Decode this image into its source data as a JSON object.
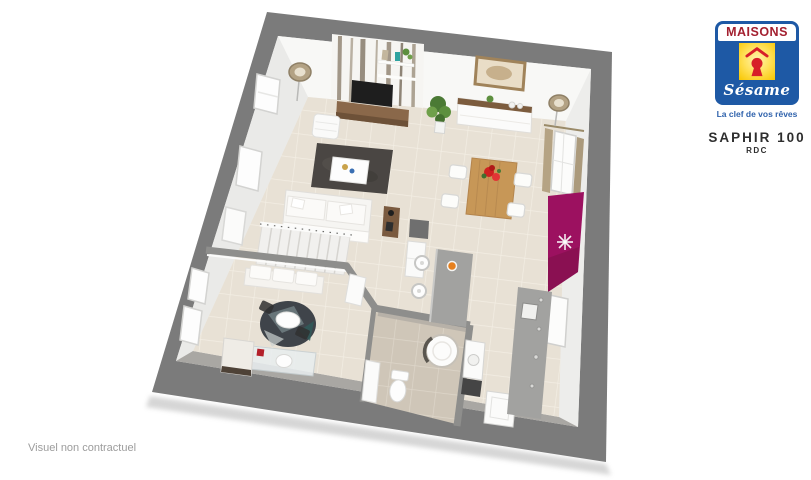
{
  "brand": {
    "name": "MAISONS",
    "script_name": "Sésame",
    "tagline": "La clef de vos rêves",
    "logo_icon": "keyhole-icon"
  },
  "plan": {
    "title": "SAPHIR 100",
    "level": "RDC"
  },
  "footer": {
    "disclaimer": "Visuel non contractuel"
  },
  "colors": {
    "brand-blue": "#1e59a5",
    "brand-red": "#a32030",
    "keyhole-red": "#d71f28",
    "logo-yellow": "#f8c600",
    "tagline-blue": "#2f62ac",
    "title-color": "#2e2e2e",
    "muted-gray": "#9c9c9c",
    "frame-gray": "#7b7b7b",
    "floor-beige": "#e8e1d5",
    "bath-floor": "#cfc6b8",
    "wood-brown": "#8a684a",
    "table-oak": "#c79757",
    "rug-charcoal": "#4a4643",
    "counter-gray": "#a2a2a0",
    "accent-magenta": "#9c1160"
  }
}
